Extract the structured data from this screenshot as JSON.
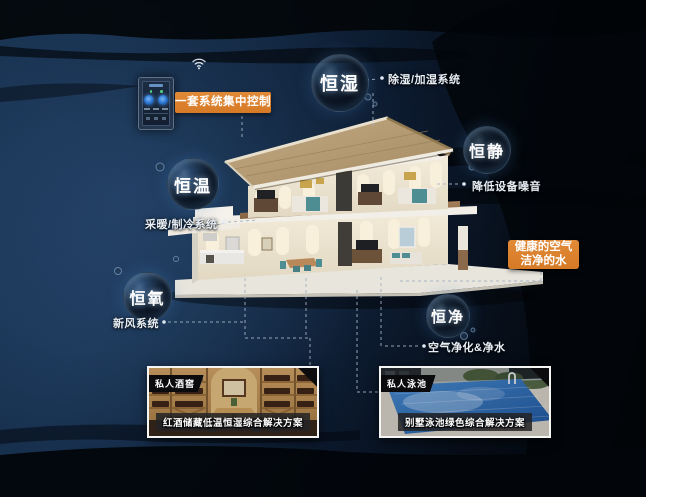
{
  "colors": {
    "accent_orange": "#d67a26",
    "background_navy": "#122a46",
    "background_black": "#04070c",
    "bubble_text": "#ffffff",
    "label_text": "#e9eff6",
    "margin_white": "#ffffff"
  },
  "icons": [
    "wifi-icon",
    "connector-bullet",
    "smart-control-panel"
  ],
  "control_panel": {
    "label": "一套系统集中控制"
  },
  "bubbles": [
    {
      "id": "heng-shi",
      "label": "恒湿",
      "sublabel": "除湿/加湿系统"
    },
    {
      "id": "heng-jing",
      "label": "恒静",
      "sublabel": "降低设备噪音"
    },
    {
      "id": "heng-wen",
      "label": "恒温",
      "sublabel": "采暖/制冷系统"
    },
    {
      "id": "heng-yang",
      "label": "恒氧",
      "sublabel": "新风系统"
    },
    {
      "id": "heng-jing2",
      "label": "恒净",
      "sublabel": "空气净化&净水"
    }
  ],
  "callouts": {
    "air_water": {
      "line1": "健康的空气",
      "line2": "洁净的水"
    }
  },
  "photos": [
    {
      "tag": "私人酒窖",
      "caption": "红酒储藏低温恒湿综合解决方案"
    },
    {
      "tag": "私人泳池",
      "caption": "别墅泳池绿色综合解决方案"
    }
  ]
}
